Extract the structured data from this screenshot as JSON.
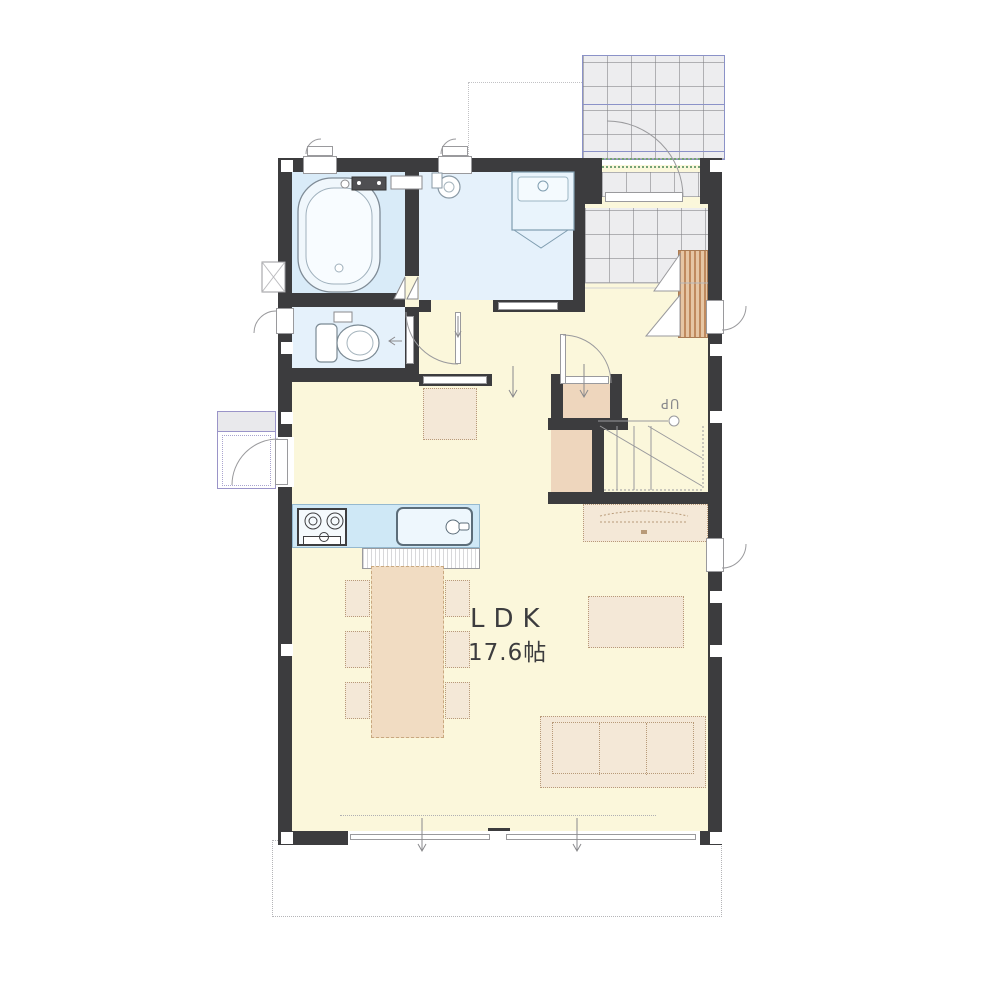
{
  "labels": {
    "room_name": "LDK",
    "room_size": "17.6帖",
    "stairs_direction": "UP"
  },
  "colors": {
    "wall": "#3c3c3e",
    "floor": "#fbf7db",
    "wet-floor": "#d9ebf8",
    "wet-floor-light": "#e5f1fb",
    "kitchen-blue": "#cfe8f6",
    "closet-tan": "#eed6bd",
    "furniture-tan": "#f4e8d7",
    "table-tan": "#f1dcc2",
    "wood-slat": "#d9ab84",
    "tile": "#ededef",
    "porch-blue": "#8b92c8",
    "step-green": "#74a276",
    "outline-gray": "#8a8a8d"
  }
}
